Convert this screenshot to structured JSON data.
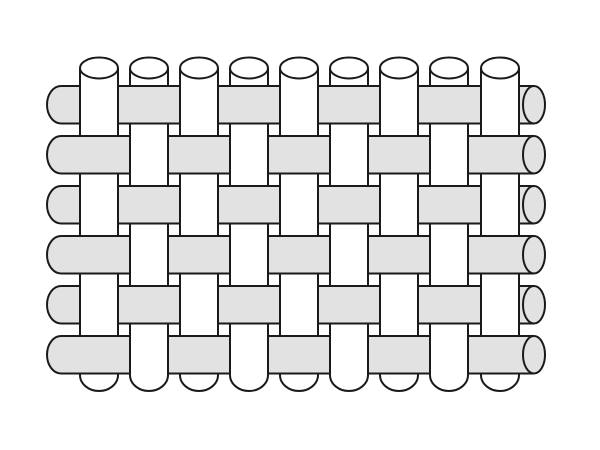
{
  "diagram": {
    "kind": "plain-weave-fabric-structure",
    "canvas": {
      "width": 600,
      "height": 450,
      "background": "#ffffff"
    },
    "palette": {
      "warp_fill": "#ffffff",
      "weft_fill": "#e2e2e3",
      "stroke": "#1a1a1a",
      "stroke_width": 2
    },
    "warp": {
      "count": 9,
      "xs": [
        80,
        130,
        180,
        230,
        280,
        330,
        380,
        430,
        481
      ],
      "width": 38,
      "top_cap_cy": 68,
      "top_cap_ry": 10.5,
      "body_bottom_y": 375,
      "bottom_cap_ry": 16
    },
    "weft": {
      "count": 6,
      "tops": [
        86,
        136,
        186,
        236,
        286,
        336
      ],
      "height": 37.5,
      "left_x": 61,
      "left_cap_rx": 14,
      "right_cap_cx": 534,
      "right_cap_rx": 11
    },
    "weave": {
      "type": "plain",
      "rule": "warp passes over weft when row and column indices share parity",
      "over_columns_by_row": [
        [
          1,
          3,
          5,
          7,
          9
        ],
        [
          2,
          4,
          6,
          8
        ],
        [
          1,
          3,
          5,
          7,
          9
        ],
        [
          2,
          4,
          6,
          8
        ],
        [
          1,
          3,
          5,
          7,
          9
        ],
        [
          2,
          4,
          6,
          8
        ]
      ]
    }
  }
}
